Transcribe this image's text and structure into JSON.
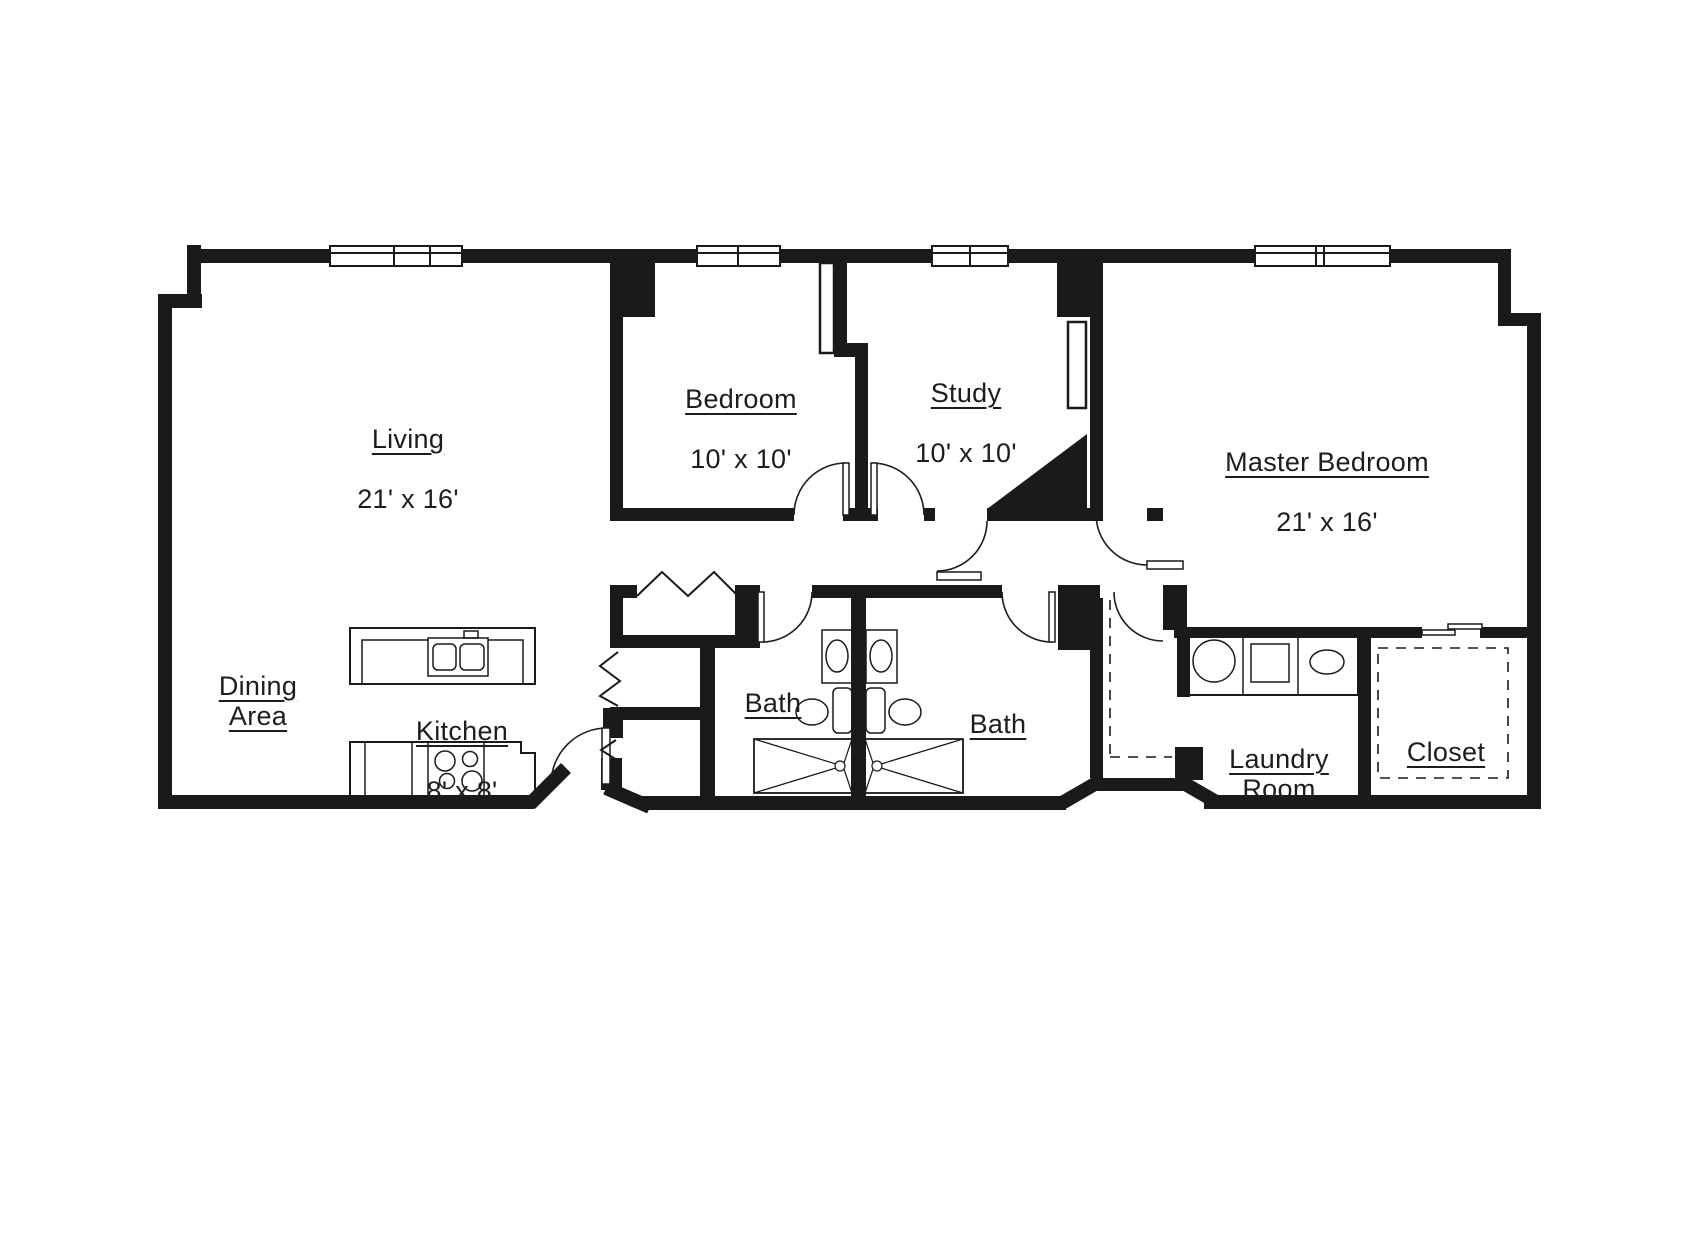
{
  "title": "Apartment floor plan",
  "colors": {
    "wall": "#1a1a1a",
    "line": "#1d1d1d",
    "background": "#ffffff"
  },
  "rooms": [
    {
      "id": "living",
      "label": "Living",
      "dims": "21' x 16'"
    },
    {
      "id": "bedroom",
      "label": "Bedroom",
      "dims": "10' x 10'"
    },
    {
      "id": "study",
      "label": "Study",
      "dims": "10' x 10'"
    },
    {
      "id": "master-bedroom",
      "label": "Master Bedroom",
      "dims": "21' x 16'"
    },
    {
      "id": "dining-area",
      "label": "Dining\nArea",
      "dims": ""
    },
    {
      "id": "kitchen",
      "label": "Kitchen",
      "dims": "8' x 8'"
    },
    {
      "id": "bath-1",
      "label": "Bath",
      "dims": ""
    },
    {
      "id": "bath-2",
      "label": "Bath",
      "dims": ""
    },
    {
      "id": "laundry-room",
      "label": "Laundry\nRoom",
      "dims": ""
    },
    {
      "id": "closet",
      "label": "Closet",
      "dims": ""
    }
  ],
  "fixtures": [
    "window",
    "entry-door-swing",
    "interior-door-swing",
    "bifold-closet-door",
    "kitchen-double-sink",
    "cooktop-burners",
    "washer",
    "dryer",
    "laundry-sink",
    "vanity-sink",
    "toilet",
    "shower-pan",
    "closet-shelving-dashed",
    "sliding-closet-door",
    "corner-chase"
  ]
}
